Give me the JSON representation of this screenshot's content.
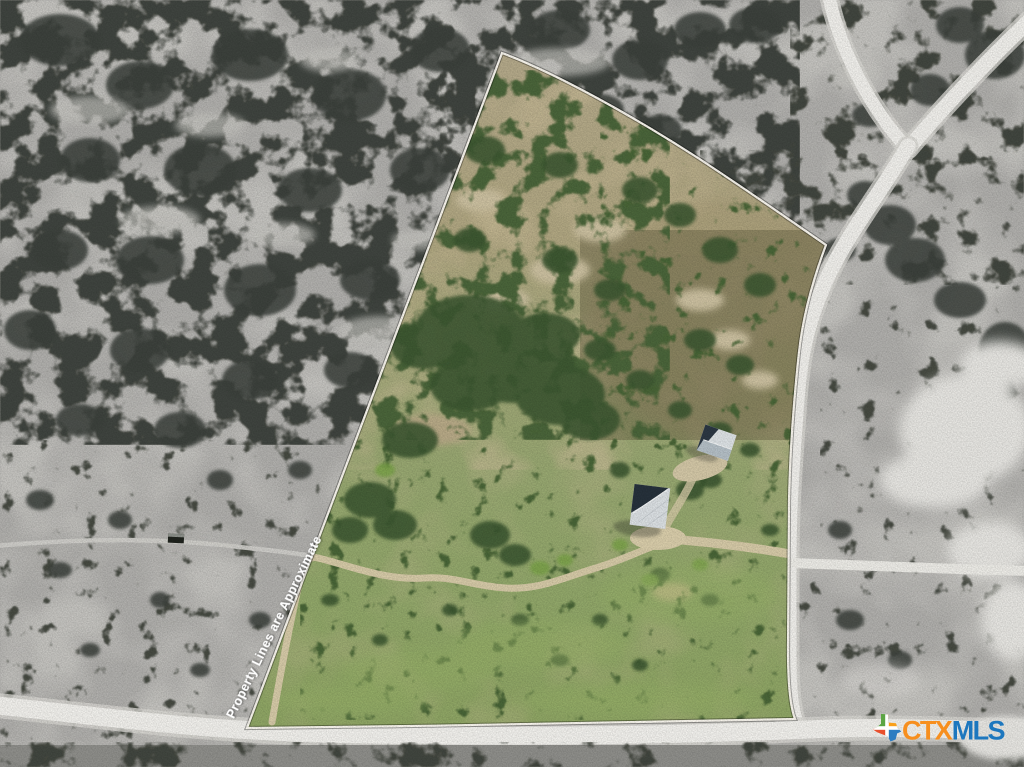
{
  "photo": {
    "kind": "aerial-drone-property-photo",
    "width_px": 1024,
    "height_px": 767
  },
  "overlay": {
    "watermark_text": "Property Lines are Approximate",
    "watermark_color": "#FFFFFF"
  },
  "property": {
    "boundary_line_color": "#FBF8F0"
  },
  "brand_logo": {
    "ctx_text": "CTX",
    "mls_text": "MLS",
    "ctx_color": "#F78F1E",
    "mls_color": "#1D77BE",
    "texas_icon": {
      "nw_color": "#5CA544",
      "ne_color": "#F9A01B",
      "sw_color": "#E8502E",
      "se_color": "#2D7DC1",
      "cross_color": "#FFFFFF"
    }
  },
  "scene_palette": {
    "offsite_ground": "#B2B1AE",
    "offsite_trees": "#3F433E",
    "road": "#F3F2EE",
    "onsite_scrub": "#B3A98A",
    "onsite_grass": "#8FA768",
    "onsite_trees": "#3D5830",
    "driveway": "#D8CCA9",
    "metal_roof": "#DDE2E5",
    "roof_shadow": "#27323C"
  }
}
